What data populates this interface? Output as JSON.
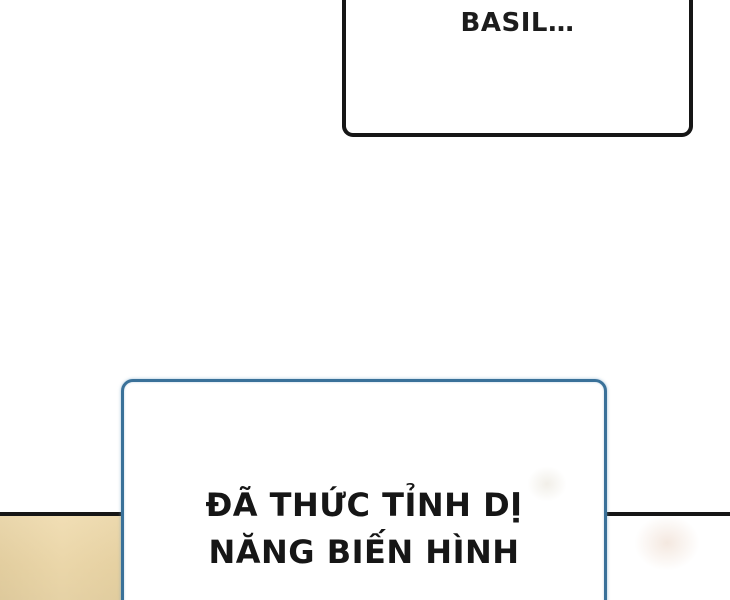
{
  "panel": {
    "type": "comic-panel",
    "background_color": "#ffffff",
    "divider_color": "#161616",
    "floor_color": "#eed8a7"
  },
  "bubble_top": {
    "text": "BASIL…",
    "border_color": "#161616",
    "fill_color": "#ffffff",
    "text_color": "#1c1c1c"
  },
  "bubble_bottom": {
    "line1": "ĐÃ THỨC TỈNH DỊ",
    "line2": "NĂNG BIẾN HÌNH",
    "border_color": "#3a7199",
    "fill_color": "#ffffff",
    "text_color": "#161616"
  }
}
